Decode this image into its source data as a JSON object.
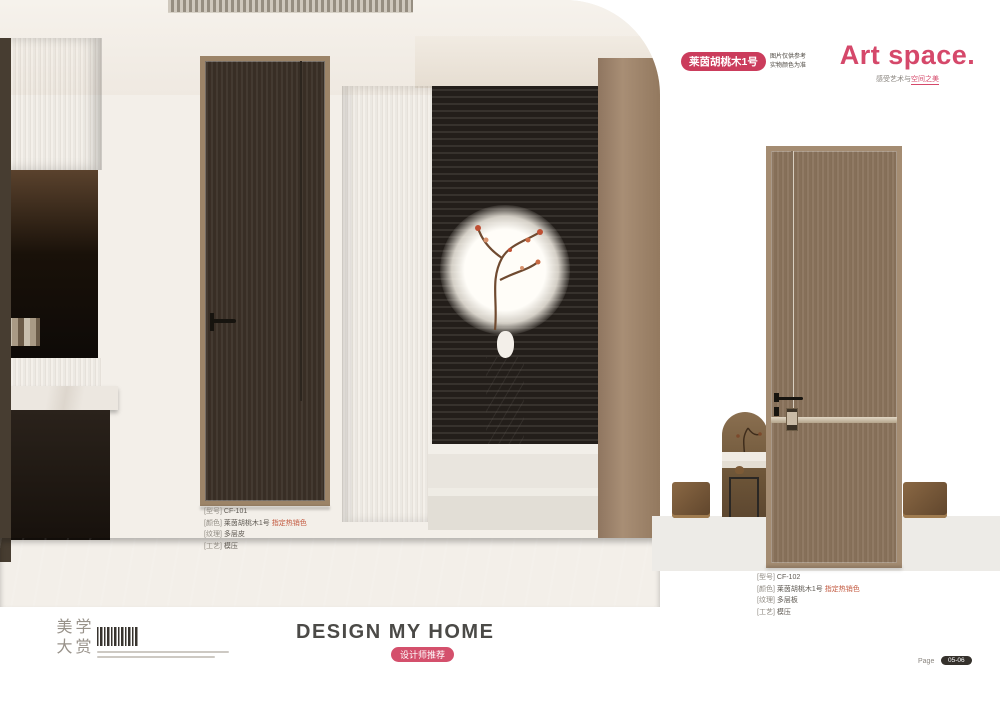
{
  "colors": {
    "accent": "#d5486a",
    "badge_red": "#cb3c5c",
    "slogan_dark": "#4b4a47"
  },
  "header": {
    "series_badge": "莱茵胡桃木1号",
    "series_note_line1": "图片仅供参考",
    "series_note_line2": "实物颜色为准",
    "brand_title": "Art space.",
    "brand_subtitle_gray": "感受艺术与",
    "brand_subtitle_accent": "空间之美"
  },
  "left_product": {
    "specs": [
      {
        "label": "[型号]",
        "value": "CF-101",
        "note": ""
      },
      {
        "label": "[颜色]",
        "value": "莱茵胡桃木1号",
        "note": "指定热销色"
      },
      {
        "label": "[纹理]",
        "value": "多层皮",
        "note": ""
      },
      {
        "label": "[工艺]",
        "value": "模压",
        "note": ""
      }
    ]
  },
  "right_product": {
    "specs": [
      {
        "label": "[型号]",
        "value": "CF-102",
        "note": ""
      },
      {
        "label": "[颜色]",
        "value": "莱茵胡桃木1号",
        "note": "指定热销色"
      },
      {
        "label": "[纹理]",
        "value": "多层板",
        "note": ""
      },
      {
        "label": "[工艺]",
        "value": "模压",
        "note": ""
      }
    ]
  },
  "footer": {
    "slogan": "DESIGN MY HOME",
    "recommend_badge": "设计师推荐",
    "logo_chars": [
      "美",
      "学",
      "大",
      "赏"
    ],
    "page_label": "Page",
    "page_number": "05-06"
  }
}
